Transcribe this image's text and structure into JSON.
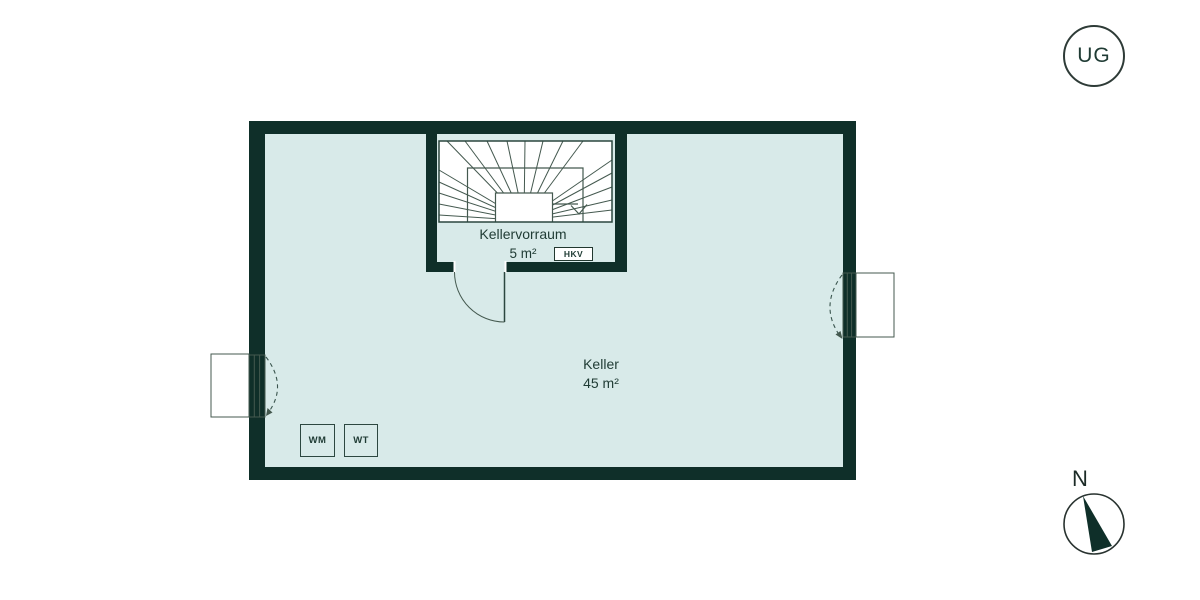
{
  "colors": {
    "wall": "#0f2f29",
    "room": "#d8eae9",
    "stair_bg": "#ffffff",
    "line": "#44594f",
    "line_strong": "#2b463f",
    "text": "#1f3b34"
  },
  "level_badge": {
    "label": "UG"
  },
  "plan": {
    "rooms": {
      "vestibule": {
        "name": "Kellervorraum",
        "area": "5 m²"
      },
      "keller": {
        "name": "Keller",
        "area": "45 m²"
      }
    },
    "fixtures": {
      "hkv": "HKV",
      "washing_machine": "WM",
      "dryer": "WT"
    }
  },
  "compass": {
    "north": "N"
  }
}
